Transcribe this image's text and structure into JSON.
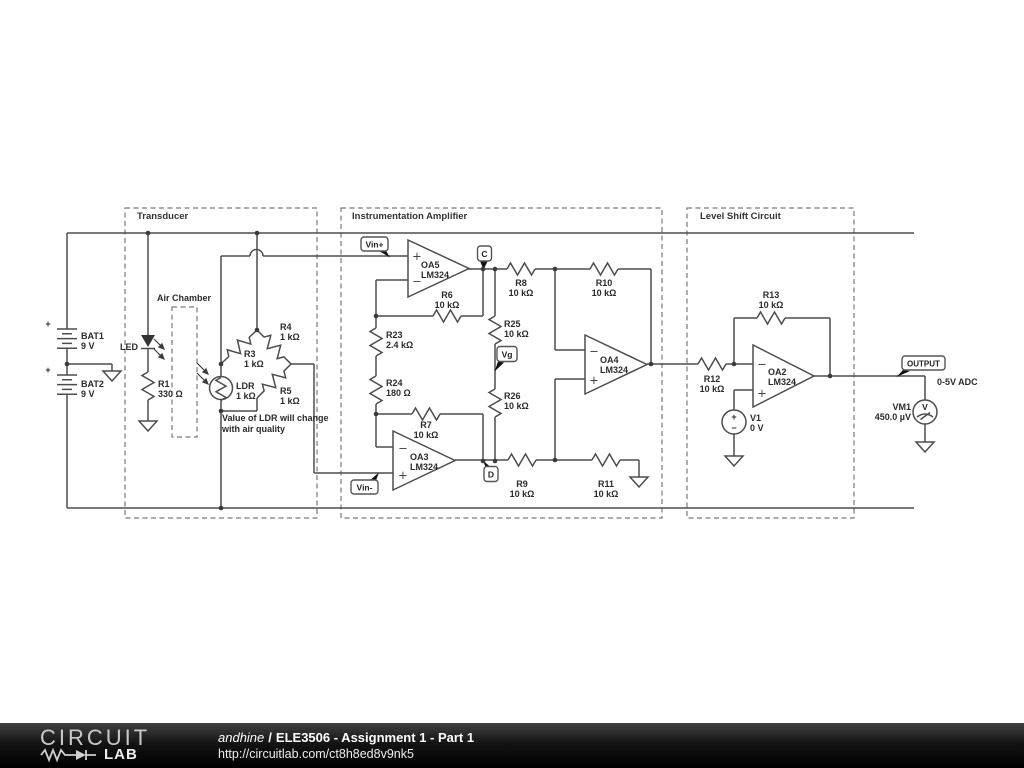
{
  "sections": {
    "transducer": {
      "label": "Transducer"
    },
    "instrumentation_amplifier": {
      "label": "Instrumentation Amplifier"
    },
    "level_shift": {
      "label": "Level Shift Circuit"
    }
  },
  "annotations": {
    "air_chamber": "Air Chamber",
    "ldr_note_line1": "Value of LDR will change",
    "ldr_note_line2": "with air quality",
    "adc_label": "0-5V ADC",
    "plus": "+",
    "minus": "−",
    "voltmeter_glyph": "V"
  },
  "flags": {
    "vin_plus": "Vin+",
    "vin_minus": "Vin-",
    "node_c": "C",
    "node_d": "D",
    "vg": "Vg",
    "output": "OUTPUT"
  },
  "components": {
    "bat1": {
      "name": "BAT1",
      "value": "9 V"
    },
    "bat2": {
      "name": "BAT2",
      "value": "9 V"
    },
    "led": {
      "name": "LED"
    },
    "r1": {
      "name": "R1",
      "value": "330 Ω"
    },
    "ldr": {
      "name": "LDR",
      "value": "1 kΩ"
    },
    "r3": {
      "name": "R3",
      "value": "1 kΩ"
    },
    "r4": {
      "name": "R4",
      "value": "1 kΩ"
    },
    "r5": {
      "name": "R5",
      "value": "1 kΩ"
    },
    "r6": {
      "name": "R6",
      "value": "10 kΩ"
    },
    "r7": {
      "name": "R7",
      "value": "10 kΩ"
    },
    "r8": {
      "name": "R8",
      "value": "10 kΩ"
    },
    "r9": {
      "name": "R9",
      "value": "10 kΩ"
    },
    "r10": {
      "name": "R10",
      "value": "10 kΩ"
    },
    "r11": {
      "name": "R11",
      "value": "10 kΩ"
    },
    "r12": {
      "name": "R12",
      "value": "10 kΩ"
    },
    "r13": {
      "name": "R13",
      "value": "10 kΩ"
    },
    "r23": {
      "name": "R23",
      "value": "2.4 kΩ"
    },
    "r24": {
      "name": "R24",
      "value": "180 Ω"
    },
    "r25": {
      "name": "R25",
      "value": "10 kΩ"
    },
    "r26": {
      "name": "R26",
      "value": "10 kΩ"
    },
    "oa2": {
      "name": "OA2",
      "value": "LM324"
    },
    "oa3": {
      "name": "OA3",
      "value": "LM324"
    },
    "oa4": {
      "name": "OA4",
      "value": "LM324"
    },
    "oa5": {
      "name": "OA5",
      "value": "LM324"
    },
    "v1": {
      "name": "V1",
      "value": "0 V"
    },
    "vm1": {
      "name": "VM1",
      "value": "450.0 µV"
    }
  },
  "footer": {
    "logo_circuit": "CIRCUIT",
    "logo_lab": "LAB",
    "author": "andhine",
    "separator": "/",
    "title": "ELE3506 - Assignment 1 - Part 1",
    "url": "http://circuitlab.com/ct8h8ed8v9nk5"
  }
}
